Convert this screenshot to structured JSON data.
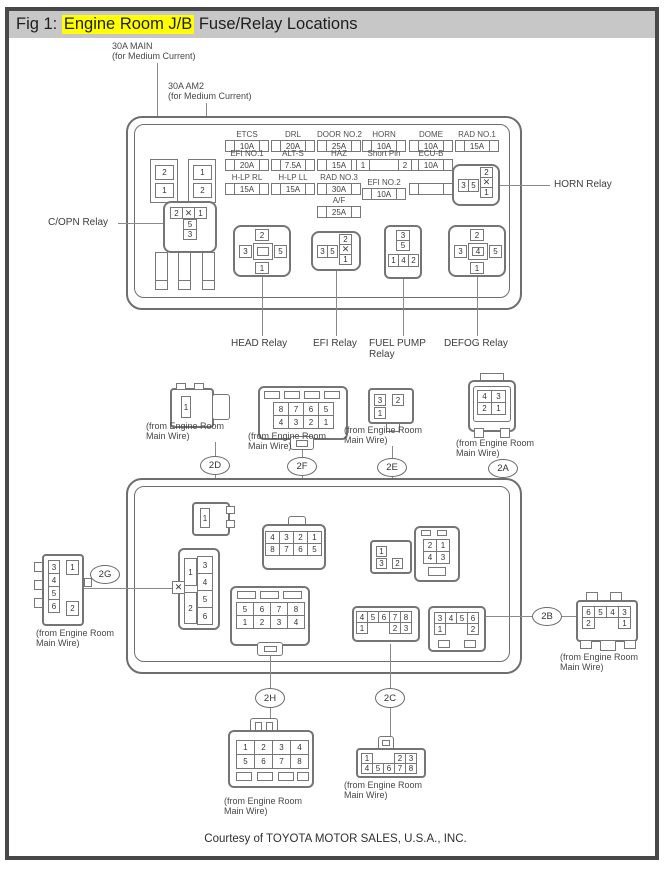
{
  "title": {
    "prefix": "Fig 1: ",
    "highlight": "Engine Room J/B",
    "suffix": " Fuse/Relay Locations"
  },
  "top_labels": {
    "main_l1": "30A MAIN",
    "main_l2": "(for Medium Current)",
    "am2_l1": "30A AM2",
    "am2_l2": "(for Medium Current)"
  },
  "fuse_blocks": {
    "a": [
      "2",
      "1"
    ],
    "b": [
      "1",
      "2"
    ]
  },
  "fuses": [
    {
      "label": "ETCS",
      "amp": "10A"
    },
    {
      "label": "EFI NO.1",
      "amp": "20A"
    },
    {
      "label": "H-LP RL",
      "amp": "15A"
    },
    {
      "label": "DRL",
      "amp": "20A"
    },
    {
      "label": "ALT-S",
      "amp": "7.5A"
    },
    {
      "label": "H-LP LL",
      "amp": "15A"
    },
    {
      "label": "DOOR NO.2",
      "amp": "25A"
    },
    {
      "label": "HAZ",
      "amp": "15A"
    },
    {
      "label": "RAD NO.3",
      "amp": "30A"
    },
    {
      "label": "A/F",
      "amp": "25A"
    },
    {
      "label": "HORN",
      "amp": "10A"
    },
    {
      "label": "EFI NO.2",
      "amp": "10A"
    },
    {
      "label": "DOME",
      "amp": "10A"
    },
    {
      "label": "ECU-B",
      "amp": "10A"
    },
    {
      "label": "RAD NO.1",
      "amp": "15A"
    }
  ],
  "short_pin": {
    "label": "Short Pin",
    "left": "1",
    "right": "2"
  },
  "relays": {
    "horn_label": "HORN Relay",
    "copn_label": "C/OPN Relay",
    "head_label": "HEAD Relay",
    "efi_label": "EFI Relay",
    "fuel_label_l1": "FUEL PUMP",
    "fuel_label_l2": "Relay",
    "defog_label": "DEFOG Relay",
    "copn": {
      "top": [
        [
          "2",
          "✕",
          "1"
        ]
      ],
      "stack": [
        [
          "5"
        ],
        [
          "3"
        ]
      ]
    },
    "horn": {
      "h": [
        [
          "3",
          "5"
        ]
      ],
      "v": [
        [
          "2"
        ],
        [
          "✕"
        ],
        [
          "1"
        ]
      ]
    },
    "efi": {
      "h": [
        [
          "3",
          "5"
        ]
      ],
      "v": [
        [
          "2"
        ],
        [
          "✕"
        ],
        [
          "1"
        ]
      ]
    },
    "head": {
      "top": "2",
      "left": "3",
      "center": "",
      "right": "5",
      "bottom": "1"
    },
    "defog": {
      "top": "2",
      "left": "3",
      "center": "4",
      "right": "5",
      "bottom": "1"
    },
    "fuel": {
      "stack": [
        [
          "3"
        ],
        [
          "5"
        ]
      ],
      "row": [
        [
          "1",
          "4",
          "2"
        ]
      ]
    }
  },
  "wire_note": {
    "l1": "(from Engine Room",
    "l2": "Main Wire)"
  },
  "tags": {
    "d": "2D",
    "f": "2F",
    "e": "2E",
    "a": "2A",
    "g": "2G",
    "b": "2B",
    "h": "2H",
    "c": "2C"
  },
  "plugs": {
    "p2d": {
      "pins": [
        [
          "1"
        ]
      ]
    },
    "p2f": {
      "pins": [
        [
          "8",
          "7",
          "6",
          "5"
        ],
        [
          "4",
          "3",
          "2",
          "1"
        ]
      ]
    },
    "p2e": {
      "pins": [
        [
          "3",
          "2"
        ],
        [
          "1",
          ""
        ]
      ]
    },
    "p2a": {
      "pins": [
        [
          "4",
          "3"
        ],
        [
          "2",
          "1"
        ]
      ]
    },
    "p2g": {
      "left": [
        [
          "3"
        ],
        [
          "4"
        ],
        [
          "5"
        ],
        [
          "6"
        ]
      ],
      "r1": "1",
      "r2": "2"
    },
    "p2b": {
      "pins": [
        [
          "6",
          "5",
          "4",
          "3"
        ],
        [
          "2",
          "",
          "",
          "1"
        ]
      ]
    },
    "p2h": {
      "pins": [
        [
          "1",
          "2",
          "3",
          "4"
        ],
        [
          "5",
          "6",
          "7",
          "8"
        ]
      ]
    },
    "p2c": {
      "pins": [
        [
          "1",
          "",
          "",
          "2",
          "3"
        ],
        [
          "4",
          "5",
          "6",
          "7",
          "8"
        ]
      ]
    }
  },
  "sockets": {
    "s2d": {
      "pins": [
        [
          "1"
        ]
      ]
    },
    "s2f": {
      "pins": [
        [
          "4",
          "3",
          "2",
          "1"
        ],
        [
          "8",
          "7",
          "6",
          "5"
        ]
      ]
    },
    "s2e": {
      "p1": "1",
      "p3": "3",
      "p2": "2"
    },
    "s2a": {
      "pins": [
        [
          "2",
          "1"
        ],
        [
          "4",
          "3"
        ]
      ]
    },
    "s2g": {
      "left1": "1",
      "left2": "2",
      "right": [
        [
          "3"
        ],
        [
          "4"
        ],
        [
          "5"
        ],
        [
          "6"
        ]
      ],
      "x": "✕"
    },
    "s2h": {
      "pins": [
        [
          "5",
          "6",
          "7",
          "8"
        ],
        [
          "1",
          "2",
          "3",
          "4"
        ]
      ]
    },
    "s2c": {
      "pins": [
        [
          "4",
          "5",
          "6",
          "7",
          "8"
        ],
        [
          "1",
          "",
          "",
          "2",
          "3"
        ]
      ]
    },
    "s2b": {
      "pins": [
        [
          "3",
          "4",
          "5",
          "6"
        ],
        [
          "1",
          "",
          "",
          "2"
        ]
      ]
    }
  },
  "footer": "Courtesy of TOYOTA MOTOR SALES, U.S.A., INC."
}
